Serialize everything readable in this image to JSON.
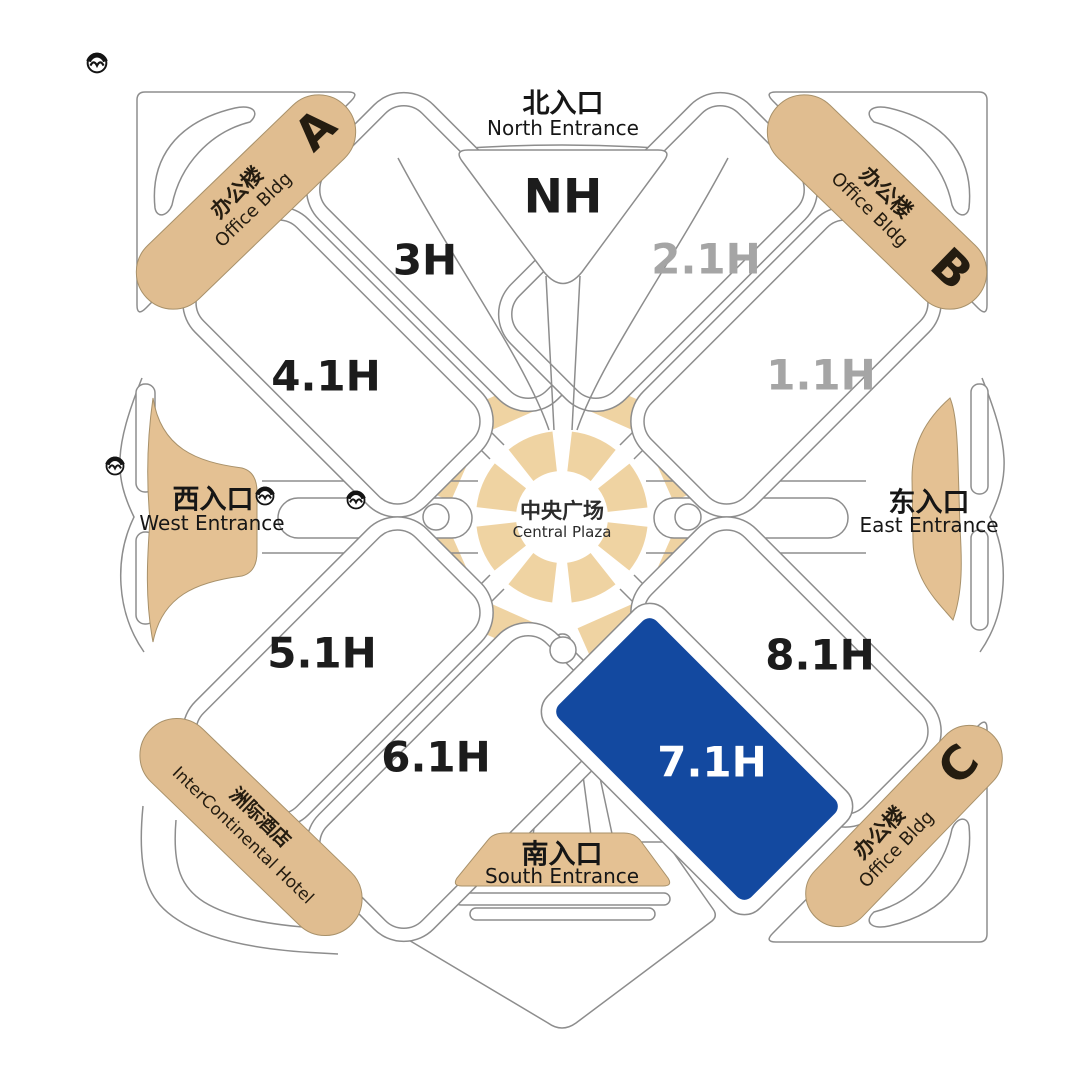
{
  "colors": {
    "accent_blue": "#1349a0",
    "building_tan": "#e0bd90",
    "plaza_tan": "#efd3a2",
    "outline_gray": "#8d8d8d",
    "inactive_hall_label": "#a5a5a5",
    "text_black": "#1c1c1c"
  },
  "plaza": {
    "zh": "中央广场",
    "en": "Central Plaza"
  },
  "entrances": {
    "north": {
      "zh": "北入口",
      "en": "North Entrance"
    },
    "west": {
      "zh": "西入口",
      "en": "West Entrance"
    },
    "east": {
      "zh": "东入口",
      "en": "East Entrance"
    },
    "south": {
      "zh": "南入口",
      "en": "South Entrance"
    }
  },
  "halls": {
    "nh": "NH",
    "h3": "3H",
    "h41": "4.1H",
    "h21": "2.1H",
    "h11": "1.1H",
    "h51": "5.1H",
    "h61": "6.1H",
    "h81": "8.1H",
    "h71": "7.1H"
  },
  "highlighted_hall": "7.1H",
  "buildings": {
    "office_a": {
      "zh": "办公楼",
      "en": "Office Bldg",
      "letter": "A"
    },
    "office_b": {
      "zh": "办公楼",
      "en": "Office Bldg",
      "letter": "B"
    },
    "office_c": {
      "zh": "办公楼",
      "en": "Office Bldg",
      "letter": "C"
    },
    "hotel": {
      "zh": "洲际酒店",
      "en": "InterContinental Hotel"
    }
  },
  "icons": {
    "metro": "metro-icon (circle with M wave)"
  }
}
